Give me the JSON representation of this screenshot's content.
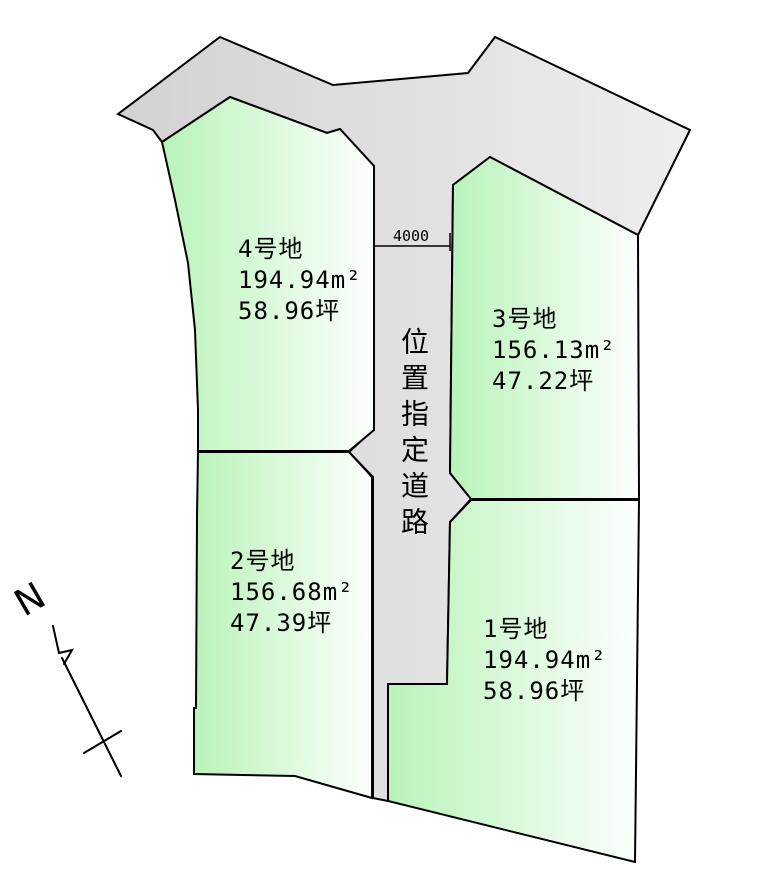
{
  "plan": {
    "kind": "land-subdivision-plan",
    "road": {
      "label": "位置指定道路",
      "width_dimension": "4000"
    },
    "compass": {
      "north_label": "N"
    },
    "lots": [
      {
        "name": "1号地",
        "area_m2": "194.94m²",
        "area_tsubo": "58.96坪"
      },
      {
        "name": "2号地",
        "area_m2": "156.68m²",
        "area_tsubo": "47.39坪"
      },
      {
        "name": "3号地",
        "area_m2": "156.13m²",
        "area_tsubo": "47.22坪"
      },
      {
        "name": "4号地",
        "area_m2": "194.94m²",
        "area_tsubo": "58.96坪"
      }
    ],
    "colors": {
      "lot_fill_left": "#b9f3b9",
      "lot_fill_right": "#fdfffd",
      "road_fill_left": "#d2d2d2",
      "road_fill_right": "#eeeeee",
      "outline": "#000000"
    }
  }
}
